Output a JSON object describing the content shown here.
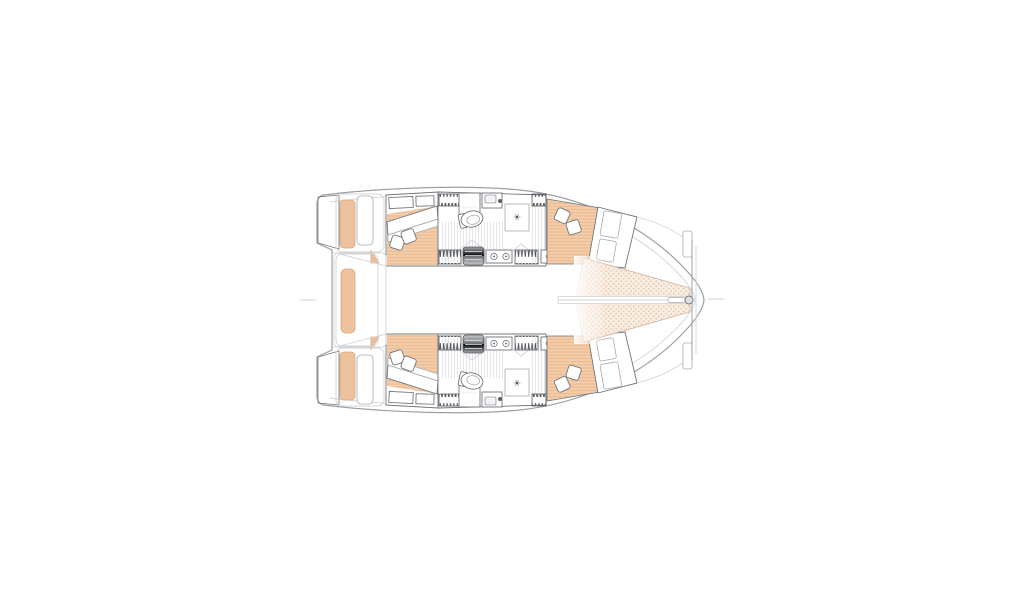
{
  "page": {
    "background_color": "#ffffff"
  },
  "diagram": {
    "type": "floor-plan",
    "subject": "catamaran sailing yacht interior deck layout, top-down view, bow pointing right",
    "colors": {
      "hull_outline": "#9aa0a5",
      "furniture_outline": "#70757a",
      "faint_line": "#d2d5d8",
      "wood_floor": "#f4cca8",
      "wood_floor_line": "#e2b28b",
      "cushion_peach": "#edc29f",
      "trampoline_fill": "#f9ece0",
      "trampoline_dot": "#e4c4ad",
      "trampoline_edge": "#cdb5a3",
      "stairs_dark": "#70757a",
      "fixture_white": "#ffffff"
    },
    "structure": {
      "hulls": [
        {
          "name": "port-hull",
          "rooms": [
            "aft-cabin",
            "head-and-companionway",
            "forward-cabin"
          ]
        },
        {
          "name": "starboard-hull",
          "rooms": [
            "aft-cabin",
            "head-and-companionway",
            "forward-cabin"
          ]
        }
      ],
      "bow_area": [
        "port-trampoline",
        "starboard-trampoline",
        "anchor-channel",
        "bow-fitting",
        "forward-crossbeam"
      ],
      "stern_area": [
        "port-transom-steps",
        "starboard-transom-steps",
        "swim-platforms",
        "center-bench"
      ],
      "fixtures": [
        "double-beds",
        "pillows",
        "toilet",
        "shower-drain",
        "washbasin",
        "companionway-stairs",
        "louvered-lockers",
        "twin-burners"
      ]
    }
  }
}
